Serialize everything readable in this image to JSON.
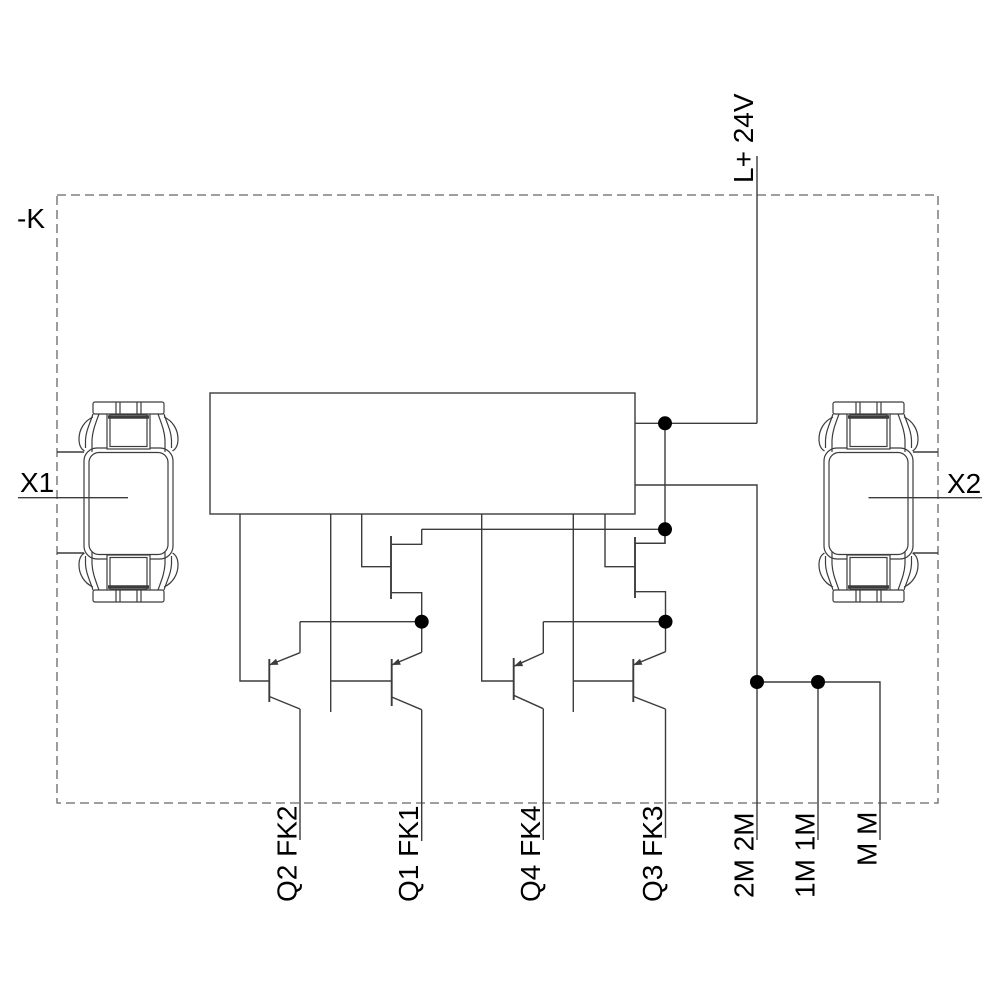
{
  "diagram": {
    "device_label": "-K",
    "supply": {
      "label": "L+ 24V"
    },
    "connectors": {
      "left": {
        "label": "X1"
      },
      "right": {
        "label": "X2"
      }
    },
    "output_channels": [
      {
        "label": "Q2 FK2"
      },
      {
        "label": "Q1 FK1"
      },
      {
        "label": "Q4 FK4"
      },
      {
        "label": "Q3 FK3"
      }
    ],
    "ground_terminals": [
      {
        "label": "2M 2M"
      },
      {
        "label": "1M 1M"
      },
      {
        "label": "M M"
      }
    ],
    "colors": {
      "line": "#3c3c3c",
      "dashed_border": "#666666",
      "text": "#000000",
      "junction_dot": "#000000",
      "background": "#ffffff"
    }
  }
}
